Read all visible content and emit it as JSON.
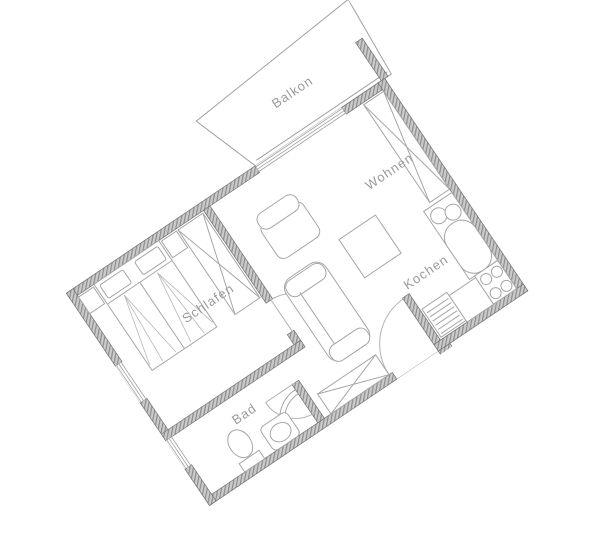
{
  "rooms": [
    {
      "id": "balkon",
      "label": "Balkon"
    },
    {
      "id": "wohnen",
      "label": "Wohnen"
    },
    {
      "id": "schlafen",
      "label": "Schlafen"
    },
    {
      "id": "kochen",
      "label": "Kochen"
    },
    {
      "id": "bad",
      "label": "Bad"
    }
  ],
  "furniture": {
    "wohnen": [
      "wardrobe",
      "armchair",
      "couch",
      "table"
    ],
    "schlafen": [
      "double-bed",
      "nightstand-left",
      "nightstand-right",
      "wardrobe"
    ],
    "kochen": [
      "counter",
      "double-sink",
      "stove-4-burners",
      "dishwasher"
    ],
    "bad": [
      "toilet",
      "washbasin",
      "corner-shower"
    ],
    "flur": [
      "wardrobe"
    ]
  },
  "openings": {
    "windows": [
      "balcony-door",
      "schlafen-window",
      "bad-window"
    ],
    "doors": [
      "entrance-door",
      "schlafen-door",
      "bad-door"
    ]
  },
  "colors": {
    "background": "#ffffff",
    "wall_base": "#cbcbcb",
    "wall_hatch_line": "#8d8d8d",
    "wall_outline": "#757575",
    "furniture_line": "#a6a6a6",
    "fan_line": "#b8b8b8",
    "door_arc": "#b3b3b3",
    "balcony_line": "#a0a0a0",
    "label_text": "#9a9a9a"
  }
}
